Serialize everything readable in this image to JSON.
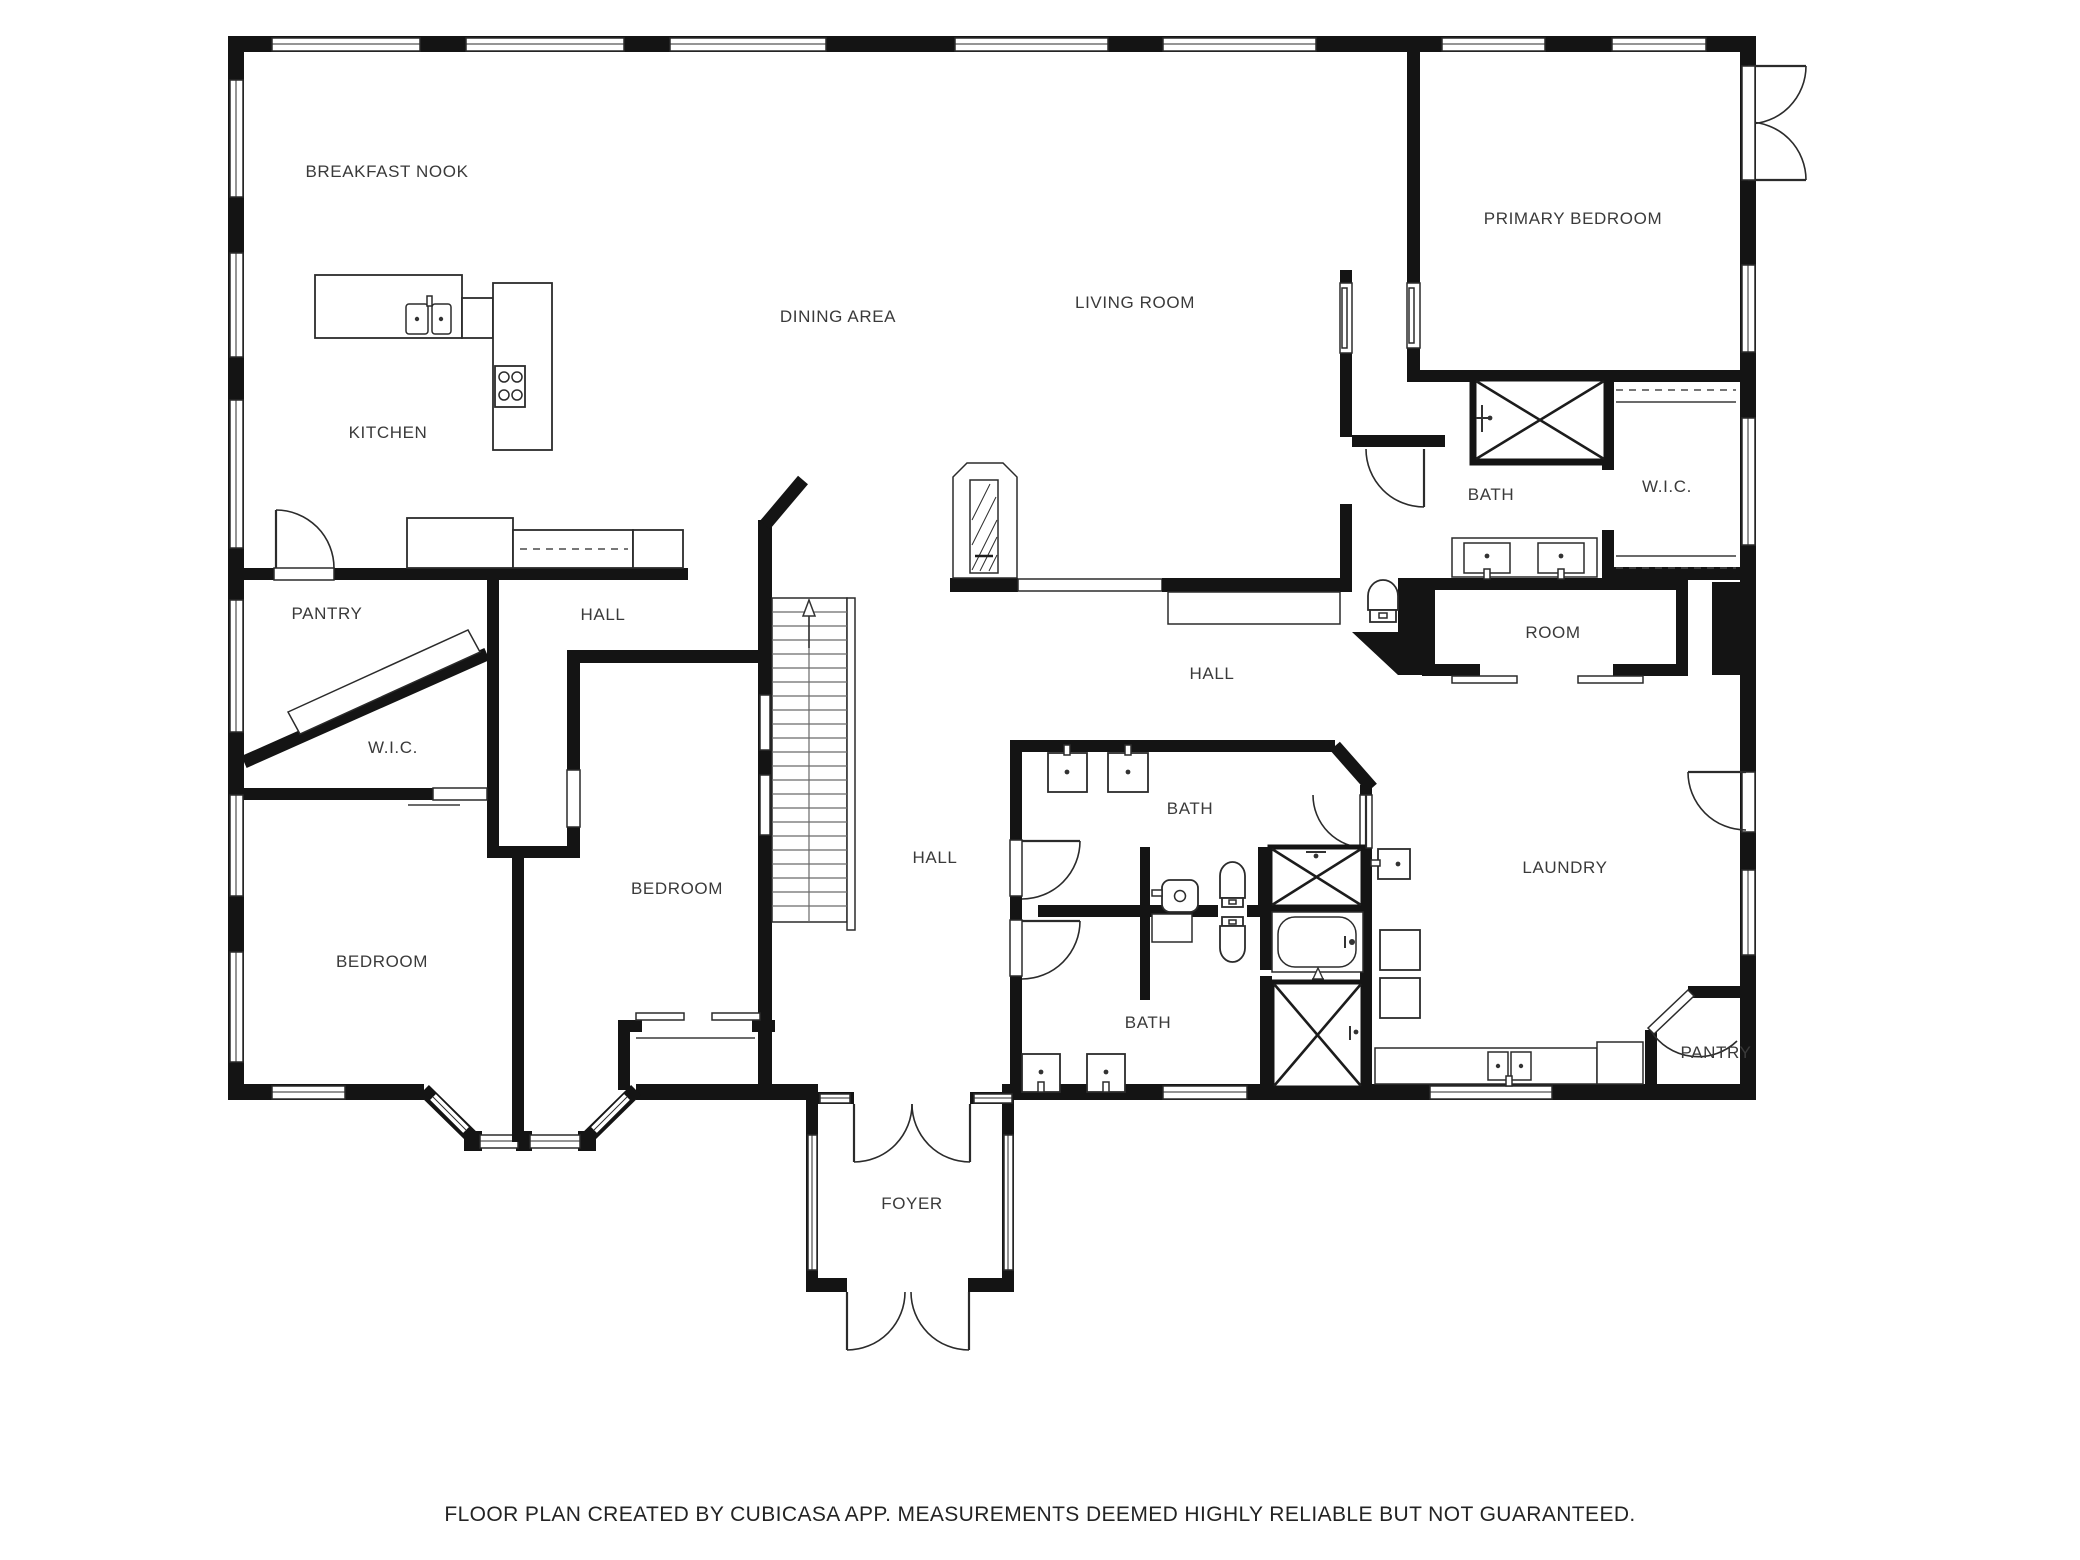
{
  "page": {
    "background": "#ffffff",
    "wall_color": "#141414",
    "label_color": "#3a3a3a"
  },
  "floor_plan": {
    "rooms": [
      {
        "id": "breakfast-nook",
        "label": "BREAKFAST NOOK"
      },
      {
        "id": "kitchen",
        "label": "KITCHEN"
      },
      {
        "id": "dining-area",
        "label": "DINING AREA"
      },
      {
        "id": "living-room",
        "label": "LIVING ROOM"
      },
      {
        "id": "primary-bedroom",
        "label": "PRIMARY BEDROOM"
      },
      {
        "id": "primary-bath",
        "label": "BATH"
      },
      {
        "id": "primary-wic",
        "label": "W.I.C."
      },
      {
        "id": "room",
        "label": "ROOM"
      },
      {
        "id": "hall-right",
        "label": "HALL"
      },
      {
        "id": "pantry-left",
        "label": "PANTRY"
      },
      {
        "id": "hall-left",
        "label": "HALL"
      },
      {
        "id": "wic-left",
        "label": "W.I.C."
      },
      {
        "id": "bedroom-left",
        "label": "BEDROOM"
      },
      {
        "id": "bedroom-center",
        "label": "BEDROOM"
      },
      {
        "id": "hall-center",
        "label": "HALL"
      },
      {
        "id": "bath-top",
        "label": "BATH"
      },
      {
        "id": "bath-bottom",
        "label": "BATH"
      },
      {
        "id": "laundry",
        "label": "LAUNDRY"
      },
      {
        "id": "pantry-right",
        "label": "PANTRY"
      },
      {
        "id": "foyer",
        "label": "FOYER"
      }
    ],
    "fixtures": [
      "kitchen-island-sink",
      "stove-4-burner",
      "kitchen-counters",
      "fireplace",
      "staircase-up-arrow",
      "shower-primary",
      "shower-hall-top",
      "shower-hall-bottom",
      "bathtub",
      "toilet-primary-bath",
      "toilet-top-bath",
      "toilet-bottom-bath",
      "vanity-double-sink-primary",
      "vanity-sinks-top-bath",
      "vanity-sinks-bottom-bath",
      "pedestal-sink",
      "laundry-wall-sink",
      "washer",
      "dryer",
      "laundry-counter-sink",
      "closet-rods",
      "sliding-closet-doors",
      "bay-window",
      "french-doors"
    ]
  },
  "footer": {
    "disclaimer": "FLOOR PLAN CREATED BY CUBICASA APP. MEASUREMENTS DEEMED HIGHLY RELIABLE BUT NOT GUARANTEED."
  }
}
